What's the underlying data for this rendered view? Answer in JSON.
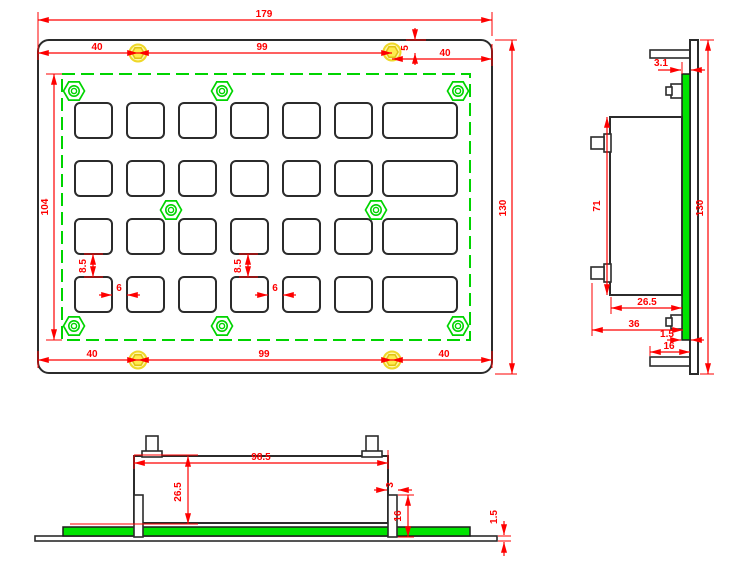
{
  "drawing": {
    "type": "engineering-drawing",
    "subject": "metal keypad panel, 3 orthographic views",
    "colors": {
      "dimension_red": "#fe0000",
      "outline_black": "#2b2b2b",
      "pcb_green": "#00e400",
      "screw_yellow": "#ffec4d"
    },
    "dims": {
      "front": {
        "total_width": "179",
        "top_left": "40",
        "top_span": "99",
        "top_inset": "5",
        "top_right": "40",
        "height": "130",
        "cutout_height": "104",
        "row_gap_left": "8.5",
        "row_gap_mid": "8.5",
        "key_gap_left": "6",
        "key_gap_mid": "6",
        "bottom_left": "40",
        "bottom_span": "99",
        "bottom_right": "40"
      },
      "side": {
        "panel_stack": "3.1",
        "height": "130",
        "body_height": "71",
        "body_depth": "26.5",
        "total_depth": "36",
        "pcb_thickness": "1.5",
        "tab_length": "16"
      },
      "bottom": {
        "mount_span": "98.5",
        "body_height": "26.5",
        "screw_width": "3",
        "screw_length": "16",
        "panel_thickness": "1.5"
      }
    }
  }
}
